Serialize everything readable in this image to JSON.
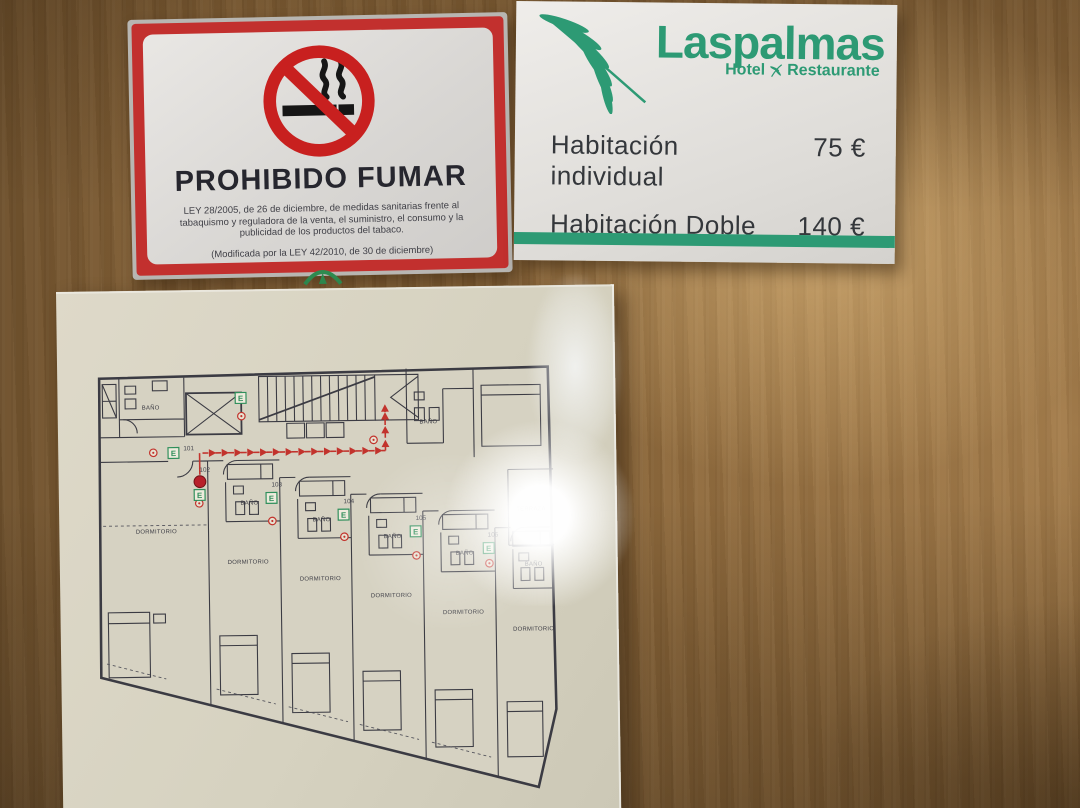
{
  "photo": {
    "no_smoking_sign": {
      "title": "PROHIBIDO FUMAR",
      "law_text": "LEY 28/2005, de 26 de diciembre, de medidas sanitarias frente al tabaquismo y reguladora de la venta, el suministro, el consumo y la publicidad de los productos del tabaco.",
      "amended_text": "(Modificada por la LEY 42/2010, de 30 de diciembre)",
      "authority": "JUNTA DE ANDALUCIA",
      "authority_dept": "CONSEJERIA DE SALUD",
      "frame_color": "#c2302e"
    },
    "hotel_card": {
      "brand": "Laspalmas",
      "subtitle_left": "Hotel",
      "subtitle_right": "Restaurante",
      "brand_color": "#2d9a74",
      "rates": [
        {
          "label": "Habitación individual",
          "price": "75 €"
        },
        {
          "label": "Habitación Doble",
          "price": "140 €"
        }
      ]
    },
    "evacuation_plan": {
      "room_numbers": [
        "101",
        "102",
        "103",
        "104",
        "105",
        "106"
      ],
      "bath_label": "BAÑO",
      "bedroom_label": "DORMITORIO",
      "terrace_label": "TERRAZA",
      "exit_letter": "E",
      "route_color": "#c2332c",
      "exit_color": "#2f8f5b"
    }
  }
}
